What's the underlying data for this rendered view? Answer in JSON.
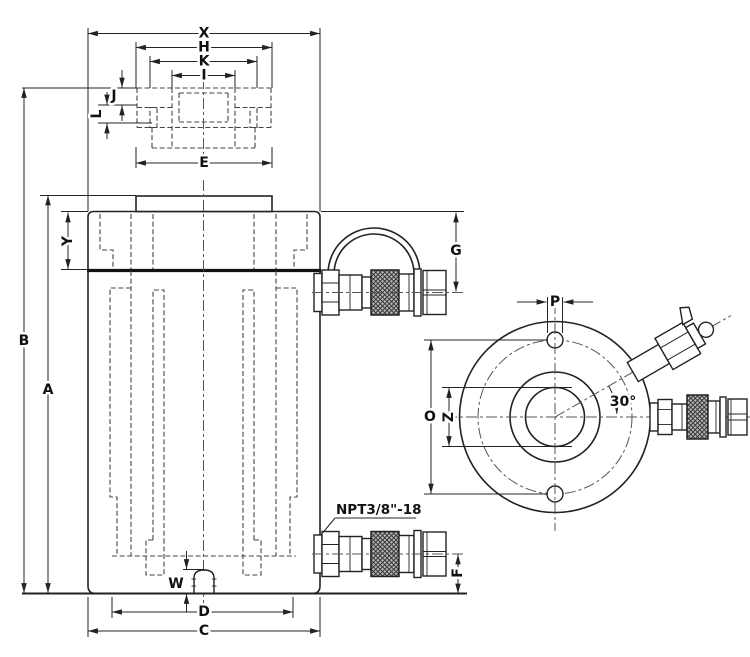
{
  "drawing": {
    "labels": {
      "X": "X",
      "H": "H",
      "K": "K",
      "I": "I",
      "J": "J",
      "L": "L",
      "E": "E",
      "Y": "Y",
      "B": "B",
      "A": "A",
      "G": "G",
      "W": "W",
      "D": "D",
      "C": "C",
      "F": "F",
      "P": "P",
      "O": "O",
      "Z": "Z",
      "angle": "30°",
      "port_thread": "NPT3/8\"-18"
    },
    "colors": {
      "line": "#222222",
      "hidden": "#454545",
      "background": "#ffffff"
    }
  }
}
